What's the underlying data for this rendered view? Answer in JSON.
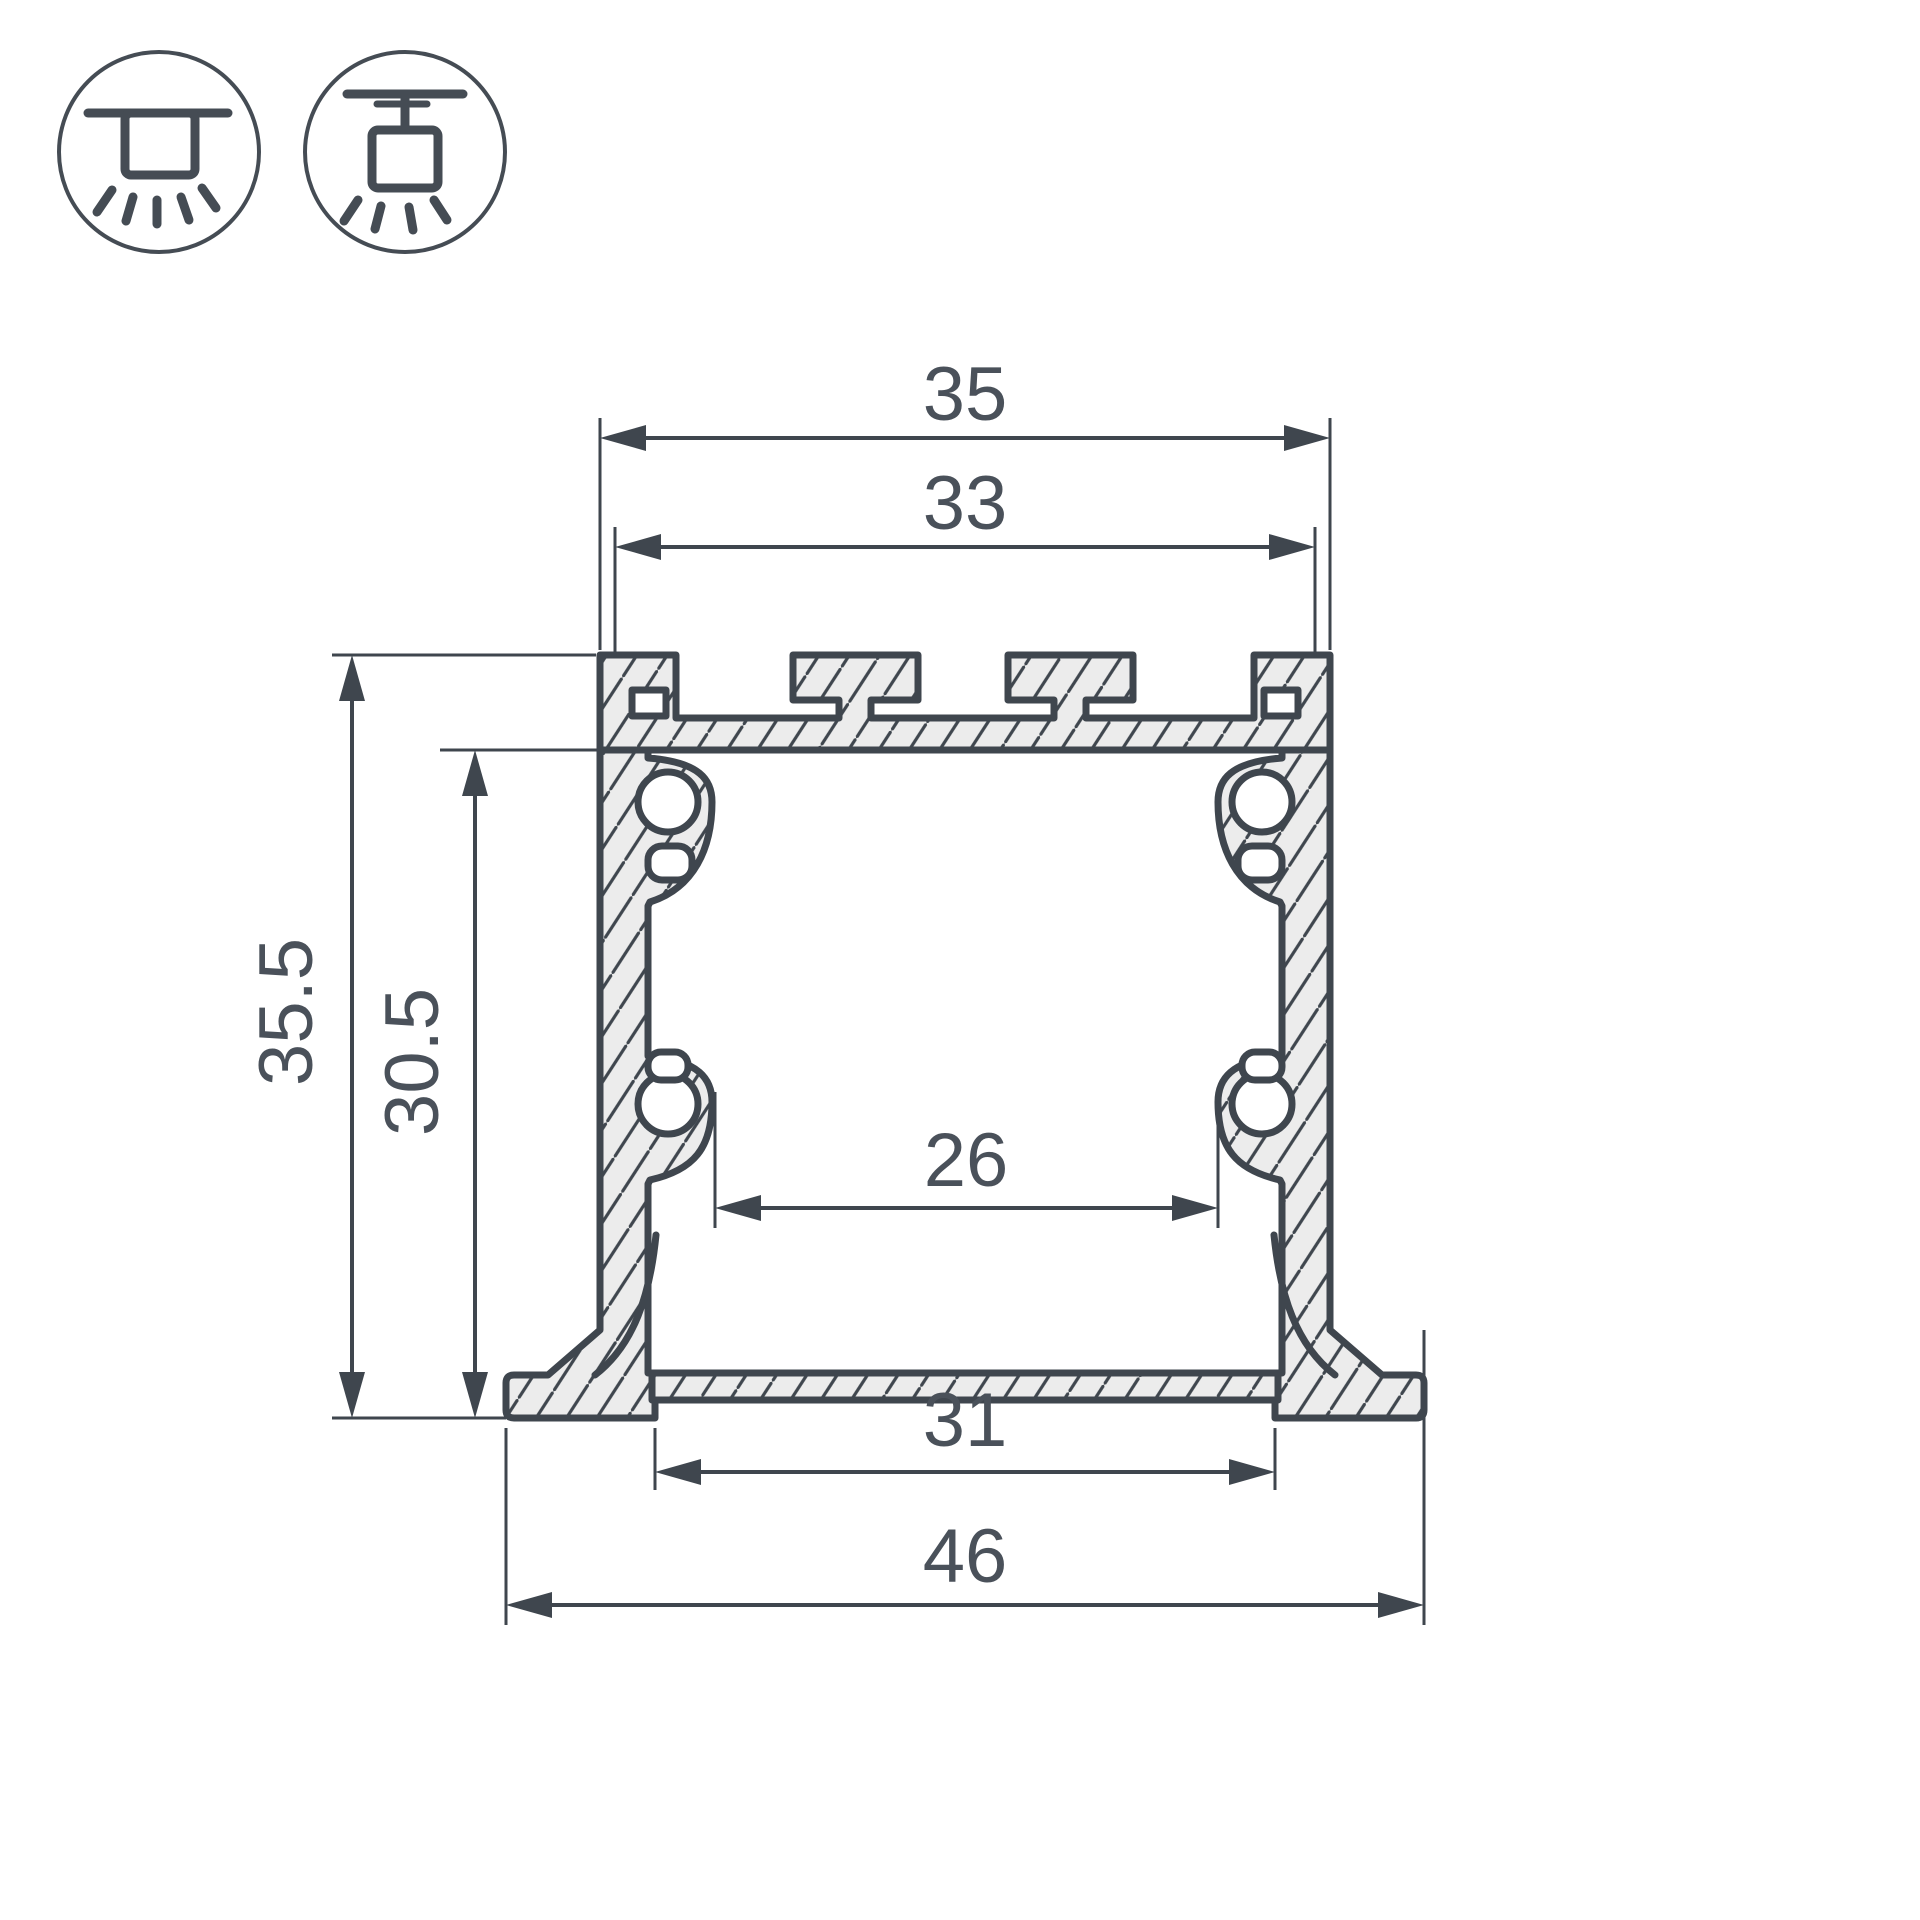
{
  "title": "Aluminium LED profile cross-section drawing",
  "icons": [
    {
      "name": "recessed-mount-icon",
      "meaning": "recessed ceiling mounting"
    },
    {
      "name": "surface-mount-icon",
      "meaning": "surface ceiling mounting"
    }
  ],
  "dimensions": {
    "top_outer_width": "35",
    "top_inner_width": "33",
    "outer_height": "35.5",
    "inner_height": "30.5",
    "inner_width": "26",
    "bottom_recess_width": "31",
    "overall_width": "46"
  },
  "colors": {
    "line": "#3f464e",
    "text": "#4a515a",
    "material_fill": "#ececec",
    "background": "#ffffff"
  }
}
